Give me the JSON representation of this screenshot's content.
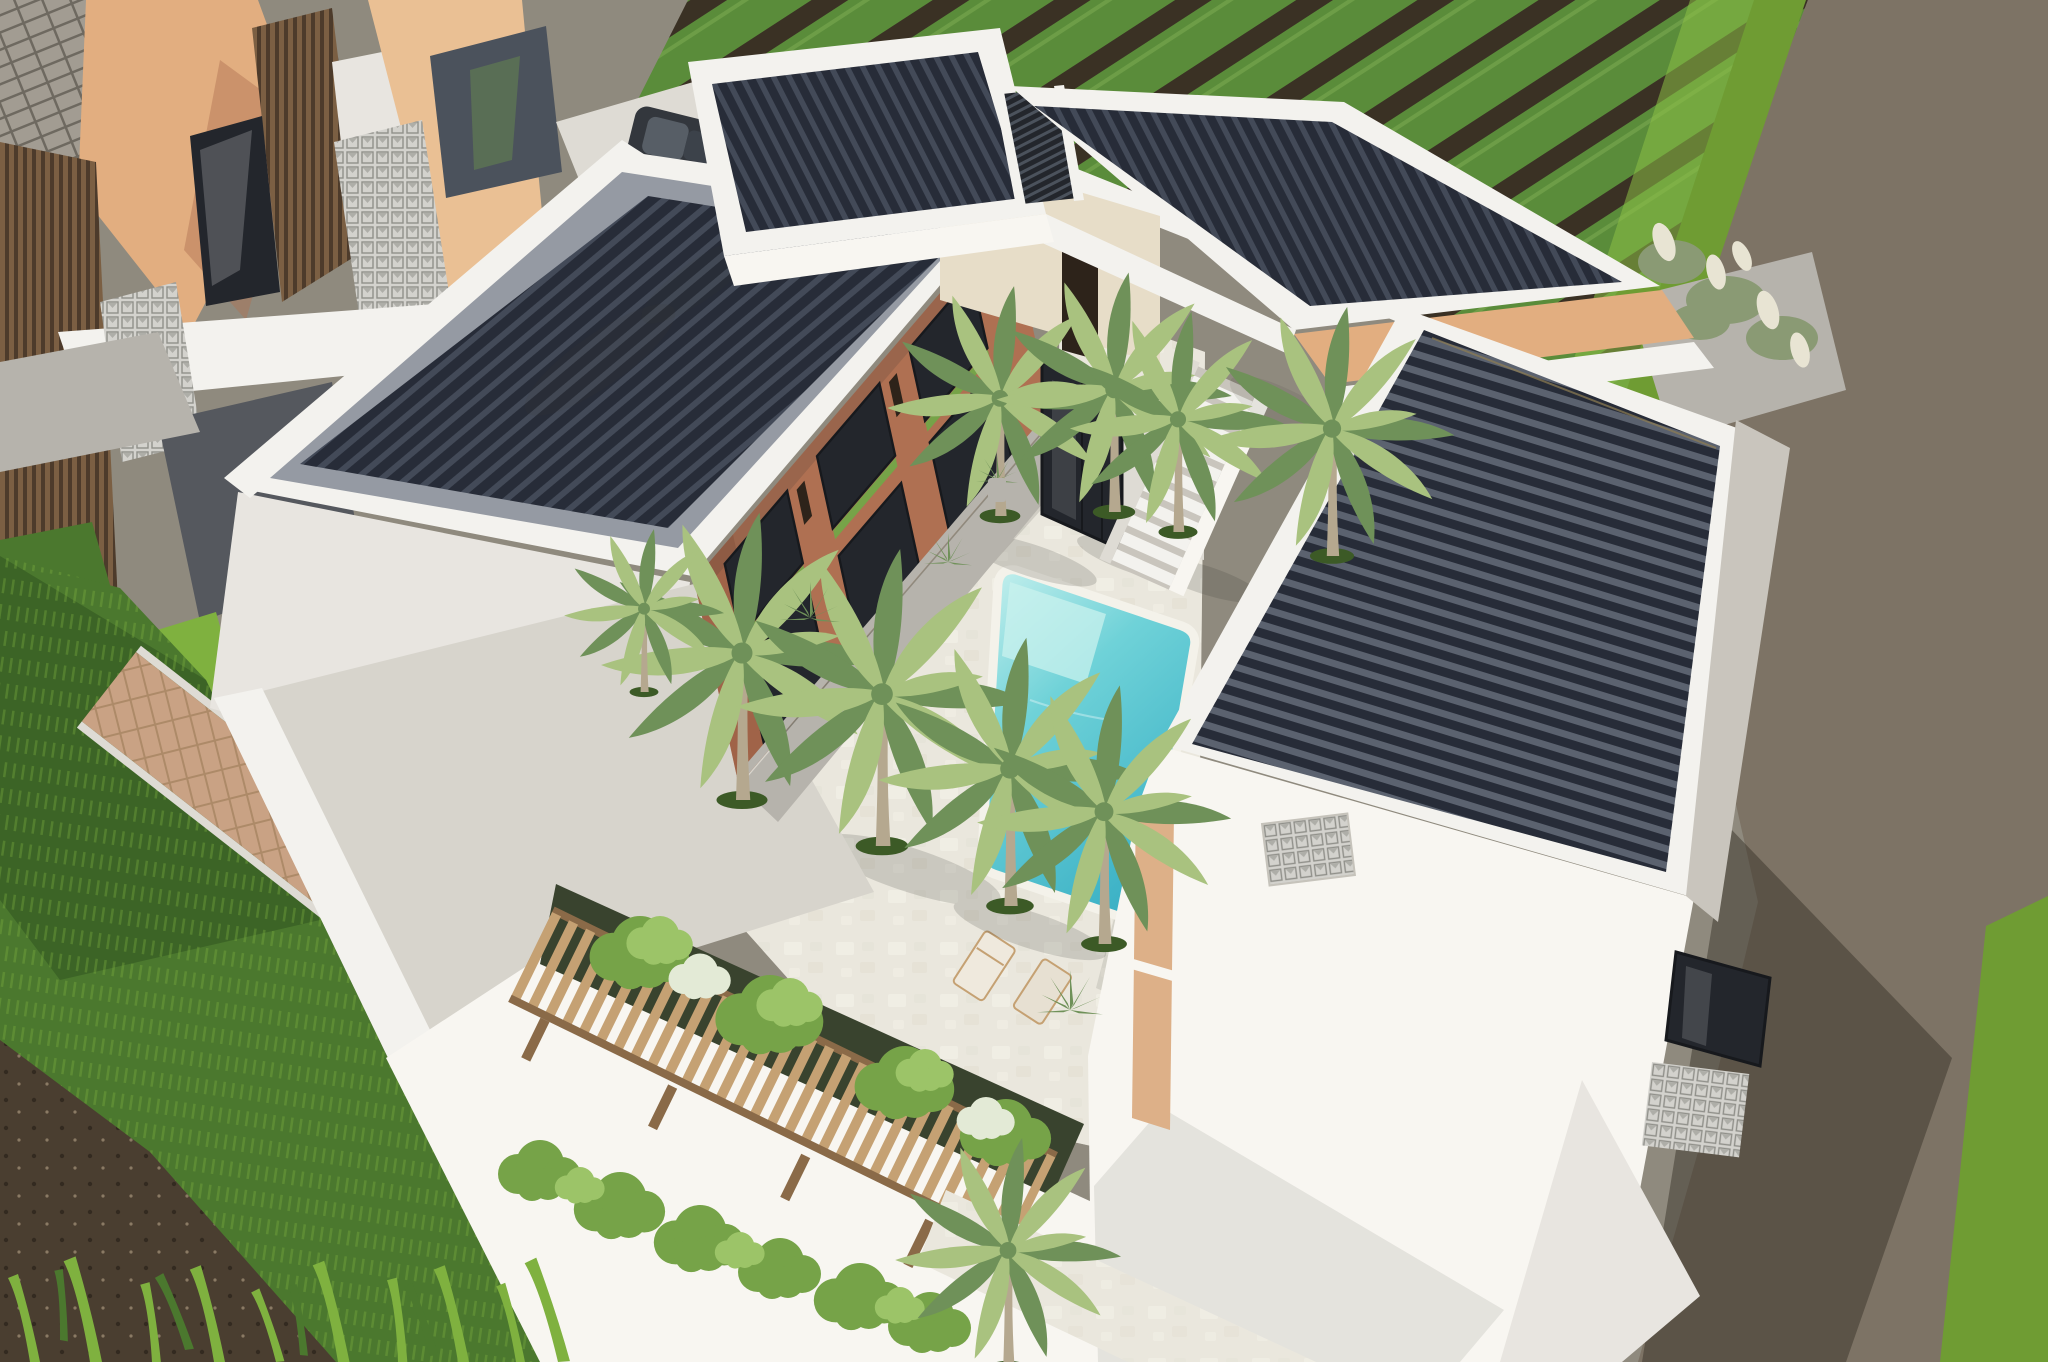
{
  "scene": {
    "description": "Aerial 3D architectural render of a modern tropical villa complex with four dark corrugated flat roofs, a central courtyard with turquoise pool and palm trees, terracotta facades, a wooden pergola, rice paddy field, dirt road and neighboring townhouses",
    "view": "aerial-top-down-oblique",
    "time_of_day": "daytime",
    "counts": {
      "roof_blocks": 4,
      "palm_trees": 10,
      "sun_loungers": 2,
      "stair_flights": 1,
      "parked_cars": 1
    }
  },
  "colors": {
    "roof_base": "#272c38",
    "roof_rib": "#434a58",
    "roof_rib_sun": "#5b626f",
    "roof_gutter": "#959aa3",
    "roof_fascia": "#c9c5bd",
    "parapet": "#f3f2ee",
    "white_bright": "#f8f6f1",
    "white_shadow": "#e8e5e0",
    "white_dim": "#dedbd4",
    "concrete_light": "#d7d4cc",
    "concrete": "#b6b3ac",
    "walk_dark": "#55585e",
    "terracotta": "#af7052",
    "terracotta_dark": "#92563d",
    "peach": "#e2ae80",
    "peach_light": "#eac094",
    "tan_strip": "#ddb088",
    "glass": "#23262c",
    "glass_light": "#4b525c",
    "interior": "#e7ddc8",
    "door_dark": "#2d231a",
    "pool_light": "#c9f1ee",
    "pool_mid": "#6fd2d8",
    "pool_deep": "#3db2c6",
    "pool_rim": "#f4f2ea",
    "pavement": "#eae7dd",
    "flag_light": "#f4f2e9",
    "flag_dark": "#ddd9cb",
    "field_green": "#5a8c3a",
    "field_soil": "#3a3124",
    "field_bright": "#8cc046",
    "field_row_light": "#7aa850",
    "lawn": "#4b782e",
    "lawn_dark": "#2e501e",
    "lawn_light": "#7fb13f",
    "soil": "#4a3e30",
    "soil_dark": "#332a20",
    "soil_fleck": "#8a7a64",
    "road": "#7d7365",
    "road_shadow": "#393429",
    "hedge": "#6f9c33",
    "shingle": "#a29c92",
    "shingle_line": "#6e6960",
    "slat_wood": "#7b5f43",
    "slat_dark": "#4d3b2b",
    "breeze": "#d3d2cd",
    "breeze_line": "#90908a",
    "paver_base": "#c9a284",
    "paver_line": "#ad8a68",
    "wood": "#c5a173",
    "wood_dark": "#8a6a48",
    "palm_light": "#a9c27f",
    "palm_dark": "#6f9159",
    "trunk": "#b5a88f",
    "ring": "#3c5a26",
    "vine": "#76a348",
    "vine_light": "#9cc468",
    "bloom": "#e3ead6",
    "pampas": "#e8e4d3",
    "shrub": "#8a9a74",
    "car": "#33373d",
    "car_glass": "#575e66",
    "underplant": "#39432e",
    "shadow": "#3b3a33",
    "backfill": "#8f8a7e"
  }
}
